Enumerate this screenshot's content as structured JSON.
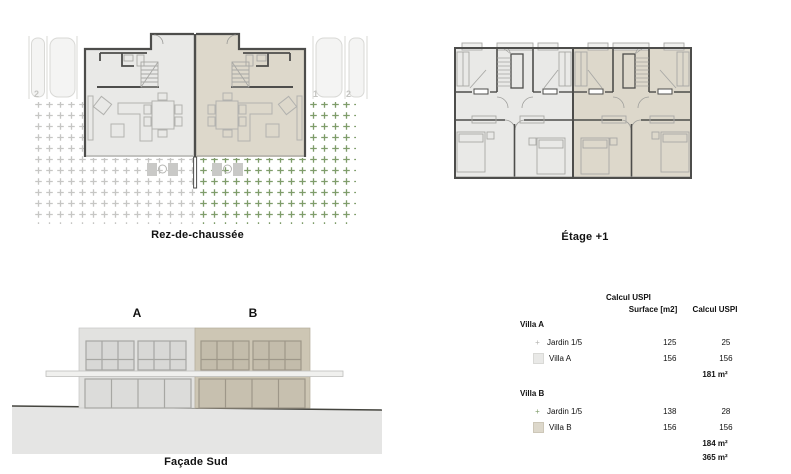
{
  "plans": {
    "ground": {
      "caption": "Rez-de-chaussée"
    },
    "floor1": {
      "caption": "Étage +1"
    },
    "facade": {
      "caption": "Façade Sud",
      "label_a": "A",
      "label_b": "B"
    },
    "parking": {
      "left": "2",
      "right1": "1",
      "right2": "2"
    }
  },
  "table": {
    "title": "Calcul USPI",
    "col_surface": "Surface [m2]",
    "col_uspi": "Calcul USPI",
    "villa_a": {
      "header": "Villa A",
      "rows": [
        {
          "swatch": "garden-gray-swatch",
          "label": "Jardin 1/5",
          "surface": "125",
          "uspi": "25"
        },
        {
          "swatch": "villa-a-swatch",
          "label": "Villa A",
          "surface": "156",
          "uspi": "156"
        }
      ],
      "total": "181 m²"
    },
    "villa_b": {
      "header": "Villa B",
      "rows": [
        {
          "swatch": "garden-green-swatch",
          "label": "Jardin 1/5",
          "surface": "138",
          "uspi": "28"
        },
        {
          "swatch": "villa-b-swatch",
          "label": "Villa B",
          "surface": "156",
          "uspi": "156"
        }
      ],
      "total": "184 m²"
    },
    "grand_total": "365 m²"
  },
  "colors": {
    "villa_a_fill": "#e9e9e7",
    "villa_b_fill": "#ddd8cb",
    "villa_a_facade": "#e2e2e0",
    "villa_b_facade": "#cdc6b4",
    "wall": "#4d4d4b",
    "furniture_line": "#b2b2af",
    "garden_gray": "#c6c6c4",
    "garden_green": "#7e9c6a",
    "ground_fill": "#e5e5e4"
  }
}
